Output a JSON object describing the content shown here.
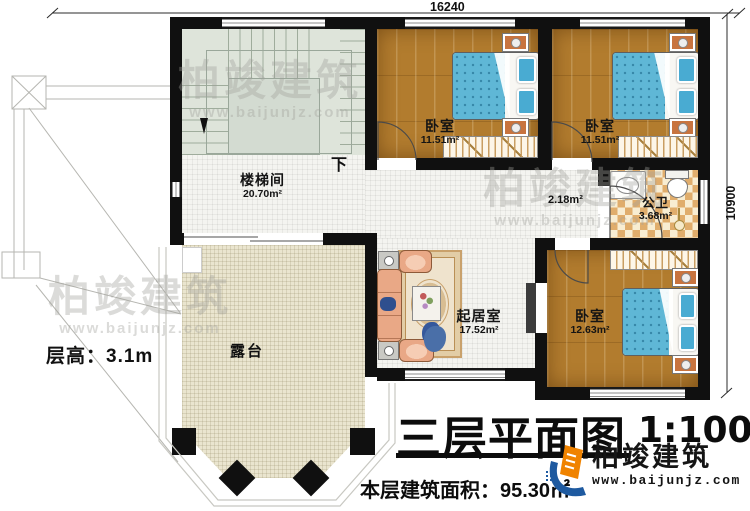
{
  "dimensions": {
    "width_top": "16240",
    "height_right": "10900"
  },
  "annotations": {
    "floor_height": "层高：3.1m",
    "stair_direction": "下"
  },
  "rooms": {
    "stairwell": {
      "name": "楼梯间",
      "area": "20.70m²"
    },
    "bedroom_top_left": {
      "name": "卧室",
      "area": "11.51m²"
    },
    "bedroom_top_right": {
      "name": "卧室",
      "area": "11.51m²"
    },
    "bedroom_bottom": {
      "name": "卧室",
      "area": "12.63m²"
    },
    "bathroom": {
      "name": "公卫",
      "area": "3.68m²"
    },
    "hallway": {
      "area": "2.18m²"
    },
    "living_room": {
      "name": "起居室",
      "area": "17.52m²"
    },
    "terrace": {
      "name": "露台"
    }
  },
  "title_block": {
    "title": "三层平面图",
    "scale": "1:100",
    "floor_area": "本层建筑面积：95.30㎡"
  },
  "brand": {
    "name": "柏竣建筑",
    "website": "www.baijunjz.com"
  },
  "watermark": {
    "name": "柏竣建筑",
    "website": "www.baijunjz.com"
  },
  "colors": {
    "wall": "#101010",
    "wood_floor": "#b27c2e",
    "bed_blue": "#5fb7d6",
    "checker_tan": "#e0ad6c",
    "terrace_floor": "#eae5cf",
    "stair_floor": "#dee4da",
    "brand_blue": "#1e5aa0",
    "brand_orange": "#f08300"
  }
}
